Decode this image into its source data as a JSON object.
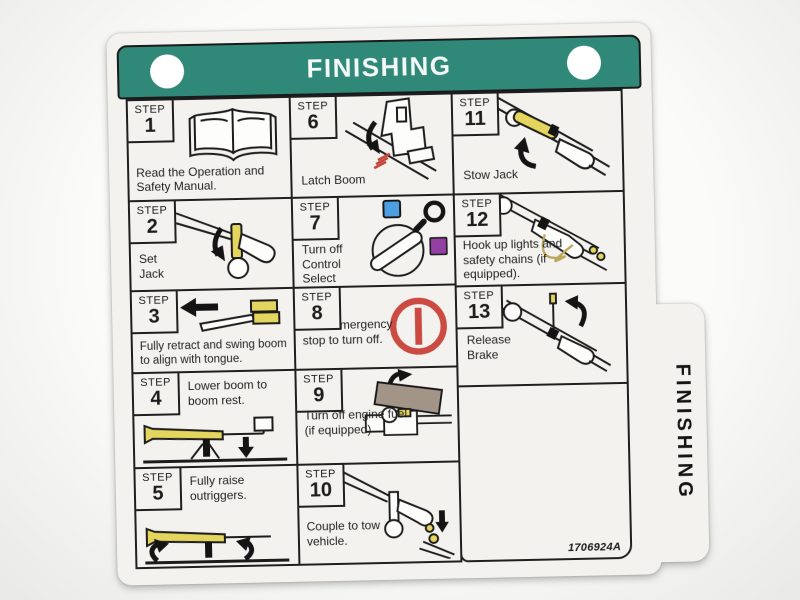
{
  "label": {
    "header": {
      "title": "FINISHING"
    },
    "side_tab": {
      "title": "FINISHING"
    },
    "part_number": "1706924A",
    "steps": [
      {
        "step_label": "STEP",
        "number": "1",
        "text": "Read the Operation and Safety Manual.",
        "icon": "open-book"
      },
      {
        "step_label": "STEP",
        "number": "2",
        "text": "Set Jack",
        "icon": "set-jack"
      },
      {
        "step_label": "STEP",
        "number": "3",
        "text": "Fully retract and swing boom to align with tongue.",
        "icon": "retract-swing-boom"
      },
      {
        "step_label": "STEP",
        "number": "4",
        "text": "Lower boom to boom rest.",
        "icon": "lower-boom"
      },
      {
        "step_label": "STEP",
        "number": "5",
        "text": "Fully raise outriggers.",
        "icon": "raise-outriggers"
      },
      {
        "step_label": "STEP",
        "number": "6",
        "text": "Latch Boom",
        "icon": "latch-boom"
      },
      {
        "step_label": "STEP",
        "number": "7",
        "text": "Turn off Control Select",
        "icon": "control-select-switch"
      },
      {
        "step_label": "STEP",
        "number": "8",
        "text": "Push emergency stop to turn off.",
        "icon": "emergency-stop"
      },
      {
        "step_label": "STEP",
        "number": "9",
        "text": "Turn off engine fuel (if equipped)",
        "icon": "engine-fuel"
      },
      {
        "step_label": "STEP",
        "number": "10",
        "text": "Couple to tow vehicle.",
        "icon": "couple-tow-vehicle"
      },
      {
        "step_label": "STEP",
        "number": "11",
        "text": "Stow Jack",
        "icon": "stow-jack"
      },
      {
        "step_label": "STEP",
        "number": "12",
        "text": "Hook up lights and safety chains (if equipped).",
        "icon": "lights-safety-chains"
      },
      {
        "step_label": "STEP",
        "number": "13",
        "text": "Release Brake",
        "icon": "release-brake"
      }
    ],
    "colors": {
      "header_teal": "#2f8878",
      "highlight_yellow": "#e4d55e",
      "stop_red": "#cb4a41",
      "select_blue": "#4d9fe2",
      "select_purple": "#9440a2"
    }
  }
}
